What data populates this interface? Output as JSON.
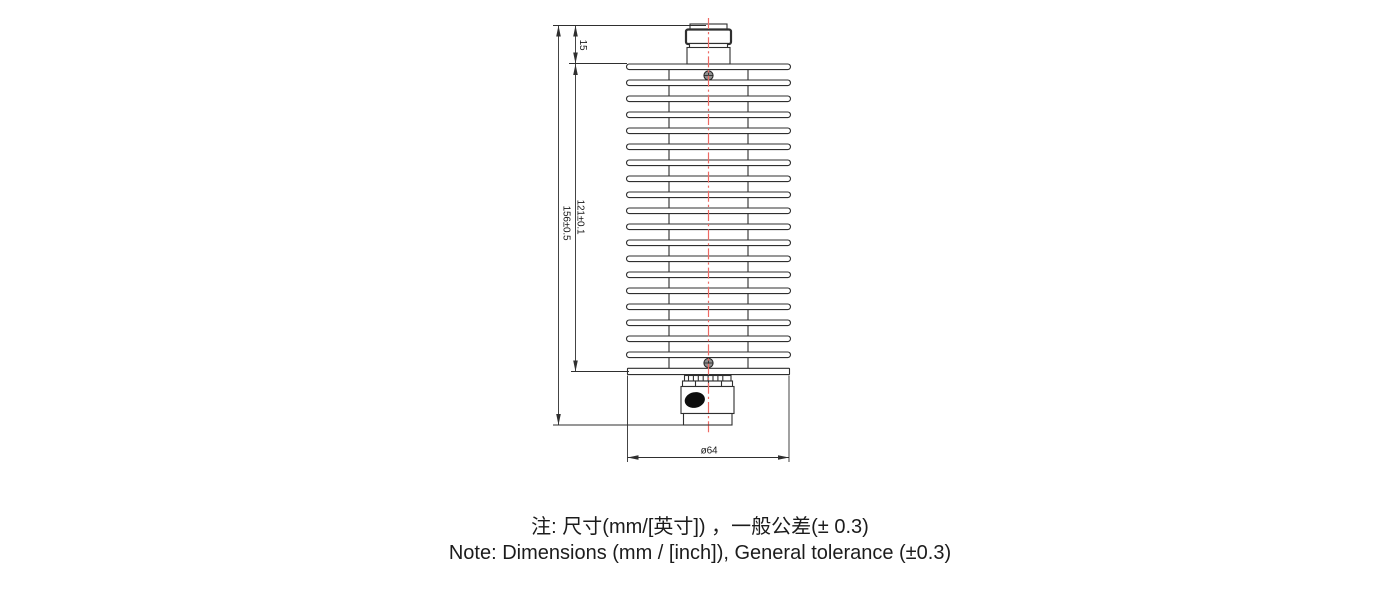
{
  "drawing": {
    "type": "engineering-dimension-drawing",
    "component": "coaxial-rf-attenuator-with-finned-heatsink",
    "dimensions": {
      "connector_height": "15",
      "heatsink_length": "121±0.1",
      "overall_length": "156±0.5",
      "diameter": "ø64"
    },
    "heatsink": {
      "fin_count": 20
    },
    "colors": {
      "line": "#2f2f2f",
      "centerline": "#ee6a64",
      "text": "#1a1a1a",
      "marking": "#0d0d0d"
    }
  },
  "notes": {
    "line_cn": "注: 尺寸(mm/[英寸]) ，一般公差(± 0.3)",
    "line_en": "Note: Dimensions (mm / [inch]), General tolerance (±0.3)"
  }
}
